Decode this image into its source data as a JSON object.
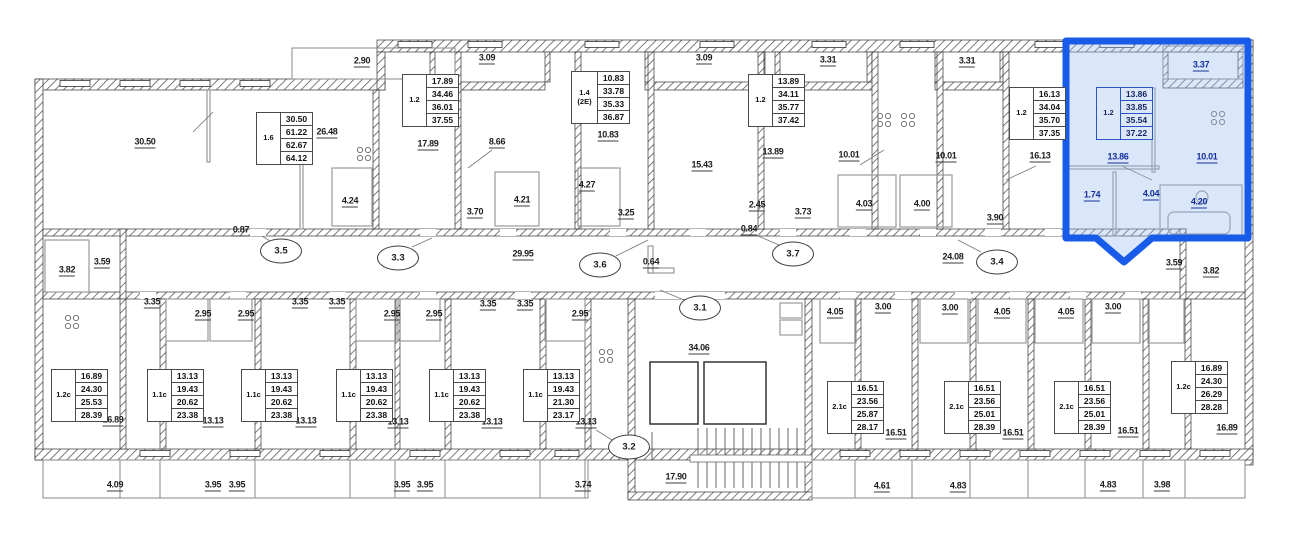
{
  "plan_meta": {
    "kind": "apartment-floor-plan",
    "selected_unit": {
      "type": "1.2",
      "total_area": "33.85",
      "areas": [
        "13.86",
        "33.85",
        "35.54",
        "37.22"
      ]
    },
    "colors": {
      "highlight_border": "#175BE8",
      "highlight_fill": "#D6E2F8",
      "wall": "#3C3C3C",
      "text": "#1D1D1D",
      "blue_text": "#15309C"
    }
  },
  "tables": [
    {
      "type": "1.6",
      "x": 256,
      "y": 112,
      "values": [
        "30.50",
        "61.22",
        "62.67",
        "64.12"
      ],
      "highlight": false
    },
    {
      "type": "1.2",
      "x": 402,
      "y": 74,
      "values": [
        "17.89",
        "34.46",
        "36.01",
        "37.55"
      ],
      "highlight": false
    },
    {
      "type": "1.4 (2Е)",
      "x": 571,
      "y": 71,
      "values": [
        "10.83",
        "33.78",
        "35.33",
        "36.87"
      ],
      "highlight": false
    },
    {
      "type": "1.2",
      "x": 748,
      "y": 74,
      "values": [
        "13.89",
        "34.11",
        "35.77",
        "37.42"
      ],
      "highlight": false
    },
    {
      "type": "1.2",
      "x": 1009,
      "y": 87,
      "values": [
        "16.13",
        "34.04",
        "35.70",
        "37.35"
      ],
      "highlight": false
    },
    {
      "type": "1.2",
      "x": 1096,
      "y": 87,
      "values": [
        "13.86",
        "33.85",
        "35.54",
        "37.22"
      ],
      "highlight": true
    },
    {
      "type": "1.2c",
      "x": 51,
      "y": 369,
      "values": [
        "16.89",
        "24.30",
        "25.53",
        "28.39"
      ],
      "highlight": false
    },
    {
      "type": "1.1c",
      "x": 147,
      "y": 369,
      "values": [
        "13.13",
        "19.43",
        "20.62",
        "23.38"
      ],
      "highlight": false
    },
    {
      "type": "1.1c",
      "x": 241,
      "y": 369,
      "values": [
        "13.13",
        "19.43",
        "20.62",
        "23.38"
      ],
      "highlight": false
    },
    {
      "type": "1.1c",
      "x": 336,
      "y": 369,
      "values": [
        "13.13",
        "19.43",
        "20.62",
        "23.38"
      ],
      "highlight": false
    },
    {
      "type": "1.1c",
      "x": 429,
      "y": 369,
      "values": [
        "13.13",
        "19.43",
        "20.62",
        "23.38"
      ],
      "highlight": false
    },
    {
      "type": "1.1c",
      "x": 523,
      "y": 369,
      "values": [
        "13.13",
        "19.43",
        "21.30",
        "23.17"
      ],
      "highlight": false
    },
    {
      "type": "2.1c",
      "x": 827,
      "y": 381,
      "values": [
        "16.51",
        "23.56",
        "25.87",
        "28.17"
      ],
      "highlight": false
    },
    {
      "type": "2.1c",
      "x": 944,
      "y": 381,
      "values": [
        "16.51",
        "23.56",
        "25.01",
        "28.39"
      ],
      "highlight": false
    },
    {
      "type": "2.1c",
      "x": 1054,
      "y": 381,
      "values": [
        "16.51",
        "23.56",
        "25.01",
        "28.39"
      ],
      "highlight": false
    },
    {
      "type": "1.2c",
      "x": 1171,
      "y": 361,
      "values": [
        "16.89",
        "24.30",
        "26.29",
        "28.28"
      ],
      "highlight": false
    }
  ],
  "labels": [
    {
      "text": "2.90",
      "x": 362,
      "y": 62,
      "blue": false
    },
    {
      "text": "3.09",
      "x": 487,
      "y": 59,
      "blue": false
    },
    {
      "text": "3.09",
      "x": 704,
      "y": 59,
      "blue": false
    },
    {
      "text": "3.31",
      "x": 828,
      "y": 61,
      "blue": false
    },
    {
      "text": "3.31",
      "x": 967,
      "y": 62,
      "blue": false
    },
    {
      "text": "3.37",
      "x": 1201,
      "y": 66,
      "blue": true
    },
    {
      "text": "30.50",
      "x": 145,
      "y": 143,
      "blue": false
    },
    {
      "text": "26.48",
      "x": 327,
      "y": 133,
      "blue": false
    },
    {
      "text": "17.89",
      "x": 428,
      "y": 145,
      "blue": false
    },
    {
      "text": "8.66",
      "x": 497,
      "y": 143,
      "blue": false
    },
    {
      "text": "10.83",
      "x": 608,
      "y": 136,
      "blue": false
    },
    {
      "text": "15.43",
      "x": 702,
      "y": 166,
      "blue": false
    },
    {
      "text": "13.89",
      "x": 773,
      "y": 153,
      "blue": false
    },
    {
      "text": "10.01",
      "x": 849,
      "y": 156,
      "blue": false
    },
    {
      "text": "10.01",
      "x": 946,
      "y": 157,
      "blue": false
    },
    {
      "text": "16.13",
      "x": 1040,
      "y": 157,
      "blue": false
    },
    {
      "text": "13.86",
      "x": 1118,
      "y": 158,
      "blue": true
    },
    {
      "text": "10.01",
      "x": 1207,
      "y": 158,
      "blue": true
    },
    {
      "text": "4.24",
      "x": 350,
      "y": 202,
      "blue": false
    },
    {
      "text": "4.21",
      "x": 522,
      "y": 201,
      "blue": false
    },
    {
      "text": "4.27",
      "x": 587,
      "y": 186,
      "blue": false
    },
    {
      "text": "3.70",
      "x": 475,
      "y": 213,
      "blue": false
    },
    {
      "text": "3.25",
      "x": 626,
      "y": 214,
      "blue": false
    },
    {
      "text": "2.45",
      "x": 757,
      "y": 206,
      "blue": false
    },
    {
      "text": "3.73",
      "x": 803,
      "y": 213,
      "blue": false
    },
    {
      "text": "4.03",
      "x": 864,
      "y": 205,
      "blue": false
    },
    {
      "text": "4.00",
      "x": 922,
      "y": 205,
      "blue": false
    },
    {
      "text": "3.90",
      "x": 995,
      "y": 219,
      "blue": false
    },
    {
      "text": "1.74",
      "x": 1092,
      "y": 196,
      "blue": true
    },
    {
      "text": "4.04",
      "x": 1151,
      "y": 195,
      "blue": true
    },
    {
      "text": "4.20",
      "x": 1199,
      "y": 203,
      "blue": true
    },
    {
      "text": "0.87",
      "x": 241,
      "y": 231,
      "blue": false
    },
    {
      "text": "0.84",
      "x": 749,
      "y": 230,
      "blue": false
    },
    {
      "text": "3.59",
      "x": 102,
      "y": 263,
      "blue": false
    },
    {
      "text": "3.82",
      "x": 67,
      "y": 271,
      "blue": false
    },
    {
      "text": "29.95",
      "x": 523,
      "y": 255,
      "blue": false
    },
    {
      "text": "0.64",
      "x": 651,
      "y": 263,
      "blue": false
    },
    {
      "text": "24.08",
      "x": 953,
      "y": 258,
      "blue": false
    },
    {
      "text": "3.59",
      "x": 1174,
      "y": 264,
      "blue": false
    },
    {
      "text": "3.82",
      "x": 1211,
      "y": 272,
      "blue": false
    },
    {
      "text": "3.35",
      "x": 152,
      "y": 303,
      "blue": false
    },
    {
      "text": "2.95",
      "x": 203,
      "y": 315,
      "blue": false
    },
    {
      "text": "2.95",
      "x": 246,
      "y": 315,
      "blue": false
    },
    {
      "text": "3.35",
      "x": 300,
      "y": 303,
      "blue": false
    },
    {
      "text": "3.35",
      "x": 337,
      "y": 303,
      "blue": false
    },
    {
      "text": "2.95",
      "x": 392,
      "y": 315,
      "blue": false
    },
    {
      "text": "2.95",
      "x": 434,
      "y": 315,
      "blue": false
    },
    {
      "text": "3.35",
      "x": 488,
      "y": 305,
      "blue": false
    },
    {
      "text": "3.35",
      "x": 525,
      "y": 305,
      "blue": false
    },
    {
      "text": "2.95",
      "x": 580,
      "y": 315,
      "blue": false
    },
    {
      "text": "4.05",
      "x": 835,
      "y": 313,
      "blue": false
    },
    {
      "text": "3.00",
      "x": 883,
      "y": 308,
      "blue": false
    },
    {
      "text": "3.00",
      "x": 950,
      "y": 309,
      "blue": false
    },
    {
      "text": "4.05",
      "x": 1002,
      "y": 313,
      "blue": false
    },
    {
      "text": "4.05",
      "x": 1066,
      "y": 313,
      "blue": false
    },
    {
      "text": "3.00",
      "x": 1113,
      "y": 308,
      "blue": false
    },
    {
      "text": "16.89",
      "x": 113,
      "y": 421,
      "blue": false
    },
    {
      "text": "13.13",
      "x": 213,
      "y": 422,
      "blue": false
    },
    {
      "text": "13.13",
      "x": 306,
      "y": 422,
      "blue": false
    },
    {
      "text": "13.13",
      "x": 398,
      "y": 423,
      "blue": false
    },
    {
      "text": "13.13",
      "x": 492,
      "y": 423,
      "blue": false
    },
    {
      "text": "13.13",
      "x": 586,
      "y": 423,
      "blue": false
    },
    {
      "text": "34.06",
      "x": 699,
      "y": 349,
      "blue": false
    },
    {
      "text": "17.90",
      "x": 676,
      "y": 478,
      "blue": false
    },
    {
      "text": "16.51",
      "x": 896,
      "y": 434,
      "blue": false
    },
    {
      "text": "16.51",
      "x": 1013,
      "y": 434,
      "blue": false
    },
    {
      "text": "16.51",
      "x": 1128,
      "y": 432,
      "blue": false
    },
    {
      "text": "16.89",
      "x": 1227,
      "y": 429,
      "blue": false
    },
    {
      "text": "4.09",
      "x": 115,
      "y": 486,
      "blue": false
    },
    {
      "text": "3.95",
      "x": 213,
      "y": 486,
      "blue": false
    },
    {
      "text": "3.95",
      "x": 237,
      "y": 486,
      "blue": false
    },
    {
      "text": "3.95",
      "x": 402,
      "y": 486,
      "blue": false
    },
    {
      "text": "3.95",
      "x": 425,
      "y": 486,
      "blue": false
    },
    {
      "text": "3.74",
      "x": 583,
      "y": 486,
      "blue": false
    },
    {
      "text": "4.61",
      "x": 882,
      "y": 487,
      "blue": false
    },
    {
      "text": "4.83",
      "x": 958,
      "y": 487,
      "blue": false
    },
    {
      "text": "4.83",
      "x": 1108,
      "y": 486,
      "blue": false
    },
    {
      "text": "3.98",
      "x": 1162,
      "y": 486,
      "blue": false
    }
  ],
  "section_circles": [
    {
      "text": "3.5",
      "x": 281,
      "y": 251
    },
    {
      "text": "3.3",
      "x": 398,
      "y": 258
    },
    {
      "text": "3.6",
      "x": 600,
      "y": 265
    },
    {
      "text": "3.7",
      "x": 793,
      "y": 254
    },
    {
      "text": "3.4",
      "x": 997,
      "y": 262
    },
    {
      "text": "3.1",
      "x": 700,
      "y": 308
    },
    {
      "text": "3.2",
      "x": 629,
      "y": 447
    }
  ]
}
